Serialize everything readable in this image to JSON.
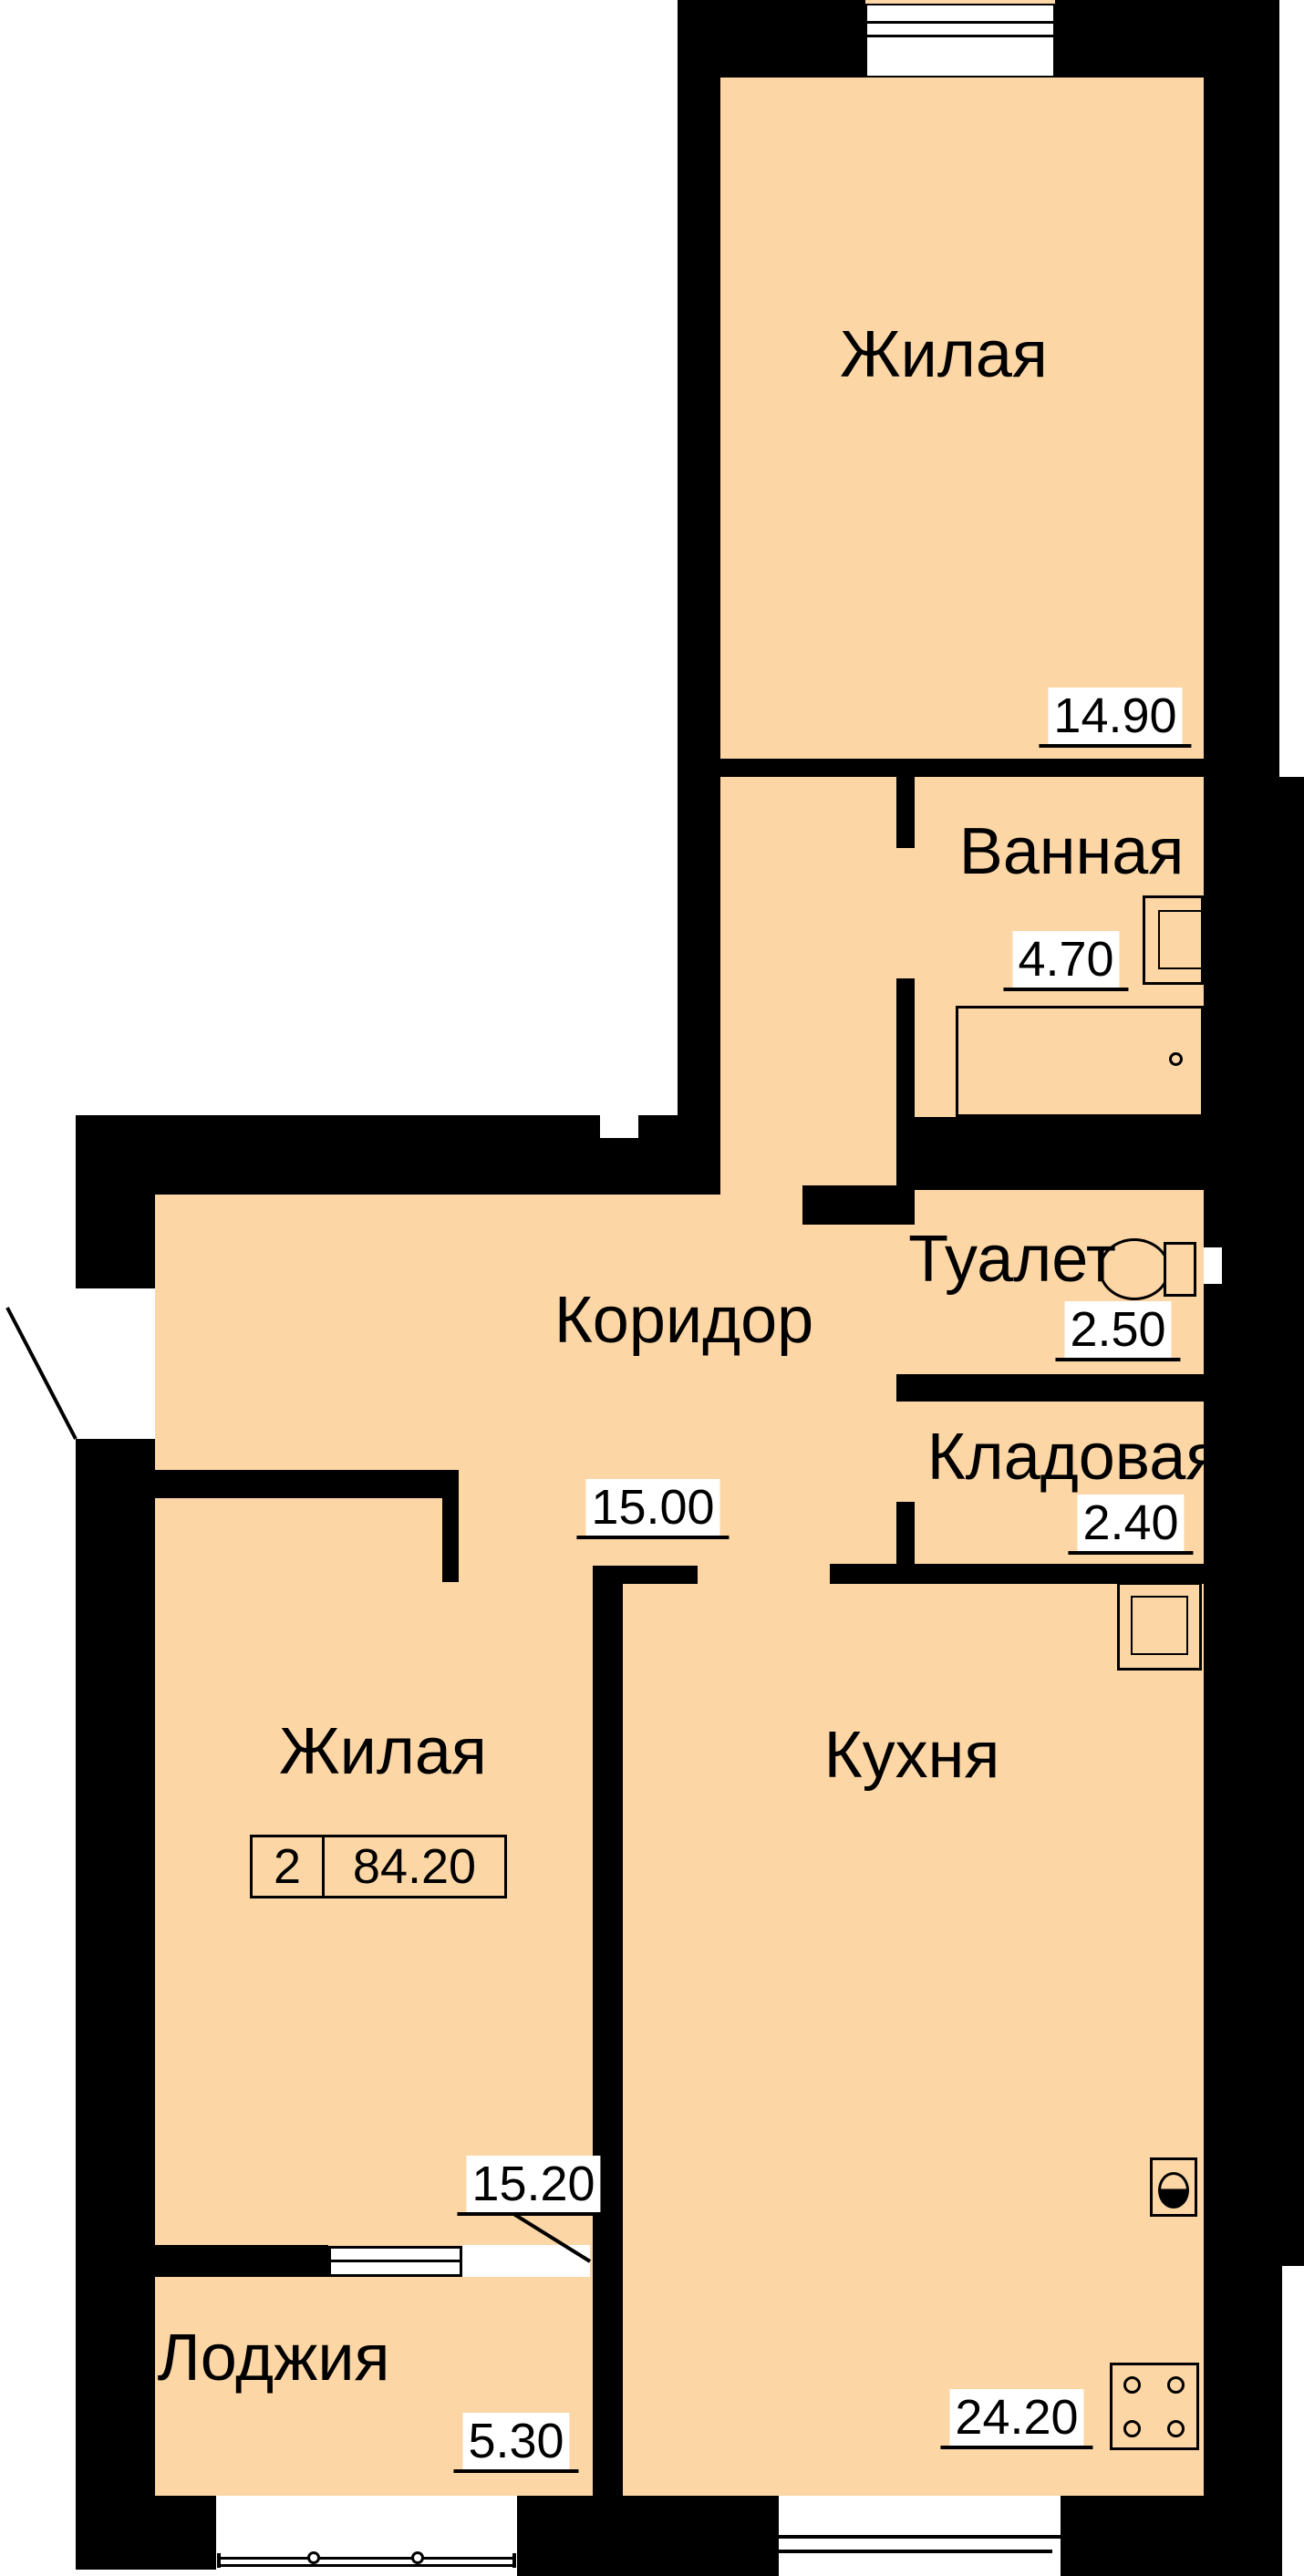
{
  "title": "Floor plan of 2-room apartment",
  "rooms": [
    {
      "id": "living-top",
      "name": "Жилая",
      "area": "14.90"
    },
    {
      "id": "bathroom",
      "name": "Ванная",
      "area": "4.70"
    },
    {
      "id": "toilet",
      "name": "Туалет",
      "area": "2.50"
    },
    {
      "id": "storage",
      "name": "Кладовая",
      "area": "2.40"
    },
    {
      "id": "corridor",
      "name": "Коридор",
      "area": "15.00"
    },
    {
      "id": "living-left",
      "name": "Жилая",
      "area": "15.20"
    },
    {
      "id": "kitchen",
      "name": "Кухня",
      "area": "24.20"
    },
    {
      "id": "loggia",
      "name": "Лоджия",
      "area": "5.30"
    }
  ],
  "summary": {
    "room_count": "2",
    "total_area": "84.20"
  },
  "icons": [
    "bathtub-icon",
    "bath-sink-icon",
    "toilet-icon",
    "vent-shaft-icon",
    "kitchen-sink-icon",
    "stove-icon",
    "window-icon",
    "door-swing-icon"
  ],
  "colors": {
    "floor": "#FCD6A5",
    "wall": "#000000",
    "exterior": "#FFFFFF"
  }
}
